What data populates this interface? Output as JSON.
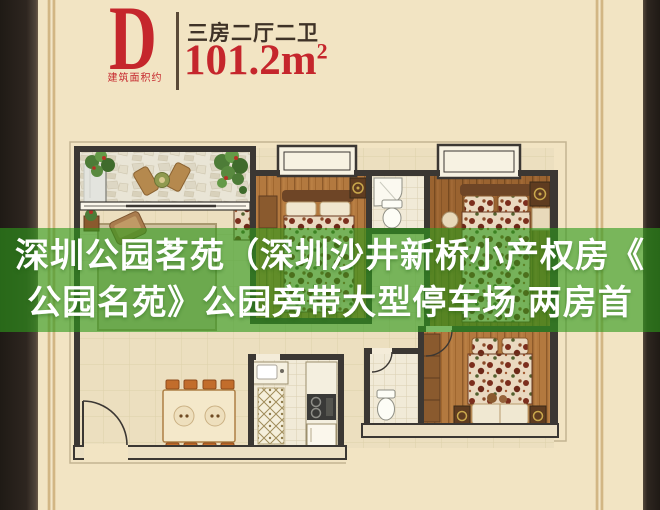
{
  "colors": {
    "background": "#f2e4c3",
    "frame_dark": "#2a231d",
    "accent_red": "#c5262c",
    "title_dark": "#3f3227",
    "overlay_green": "rgba(46,154,28,0.62)",
    "wall": "#3b3733"
  },
  "header": {
    "plan_letter": "D",
    "area_note": "建筑面积约",
    "layout_label": "三房二厅二卫",
    "area_value": "101.2",
    "area_unit": "m",
    "area_exponent": "2"
  },
  "overlay": {
    "line1": "深圳公园茗苑（深圳沙井新桥小产权房《",
    "line2": "公园名苑》公园旁带大型停车场 两房首"
  }
}
